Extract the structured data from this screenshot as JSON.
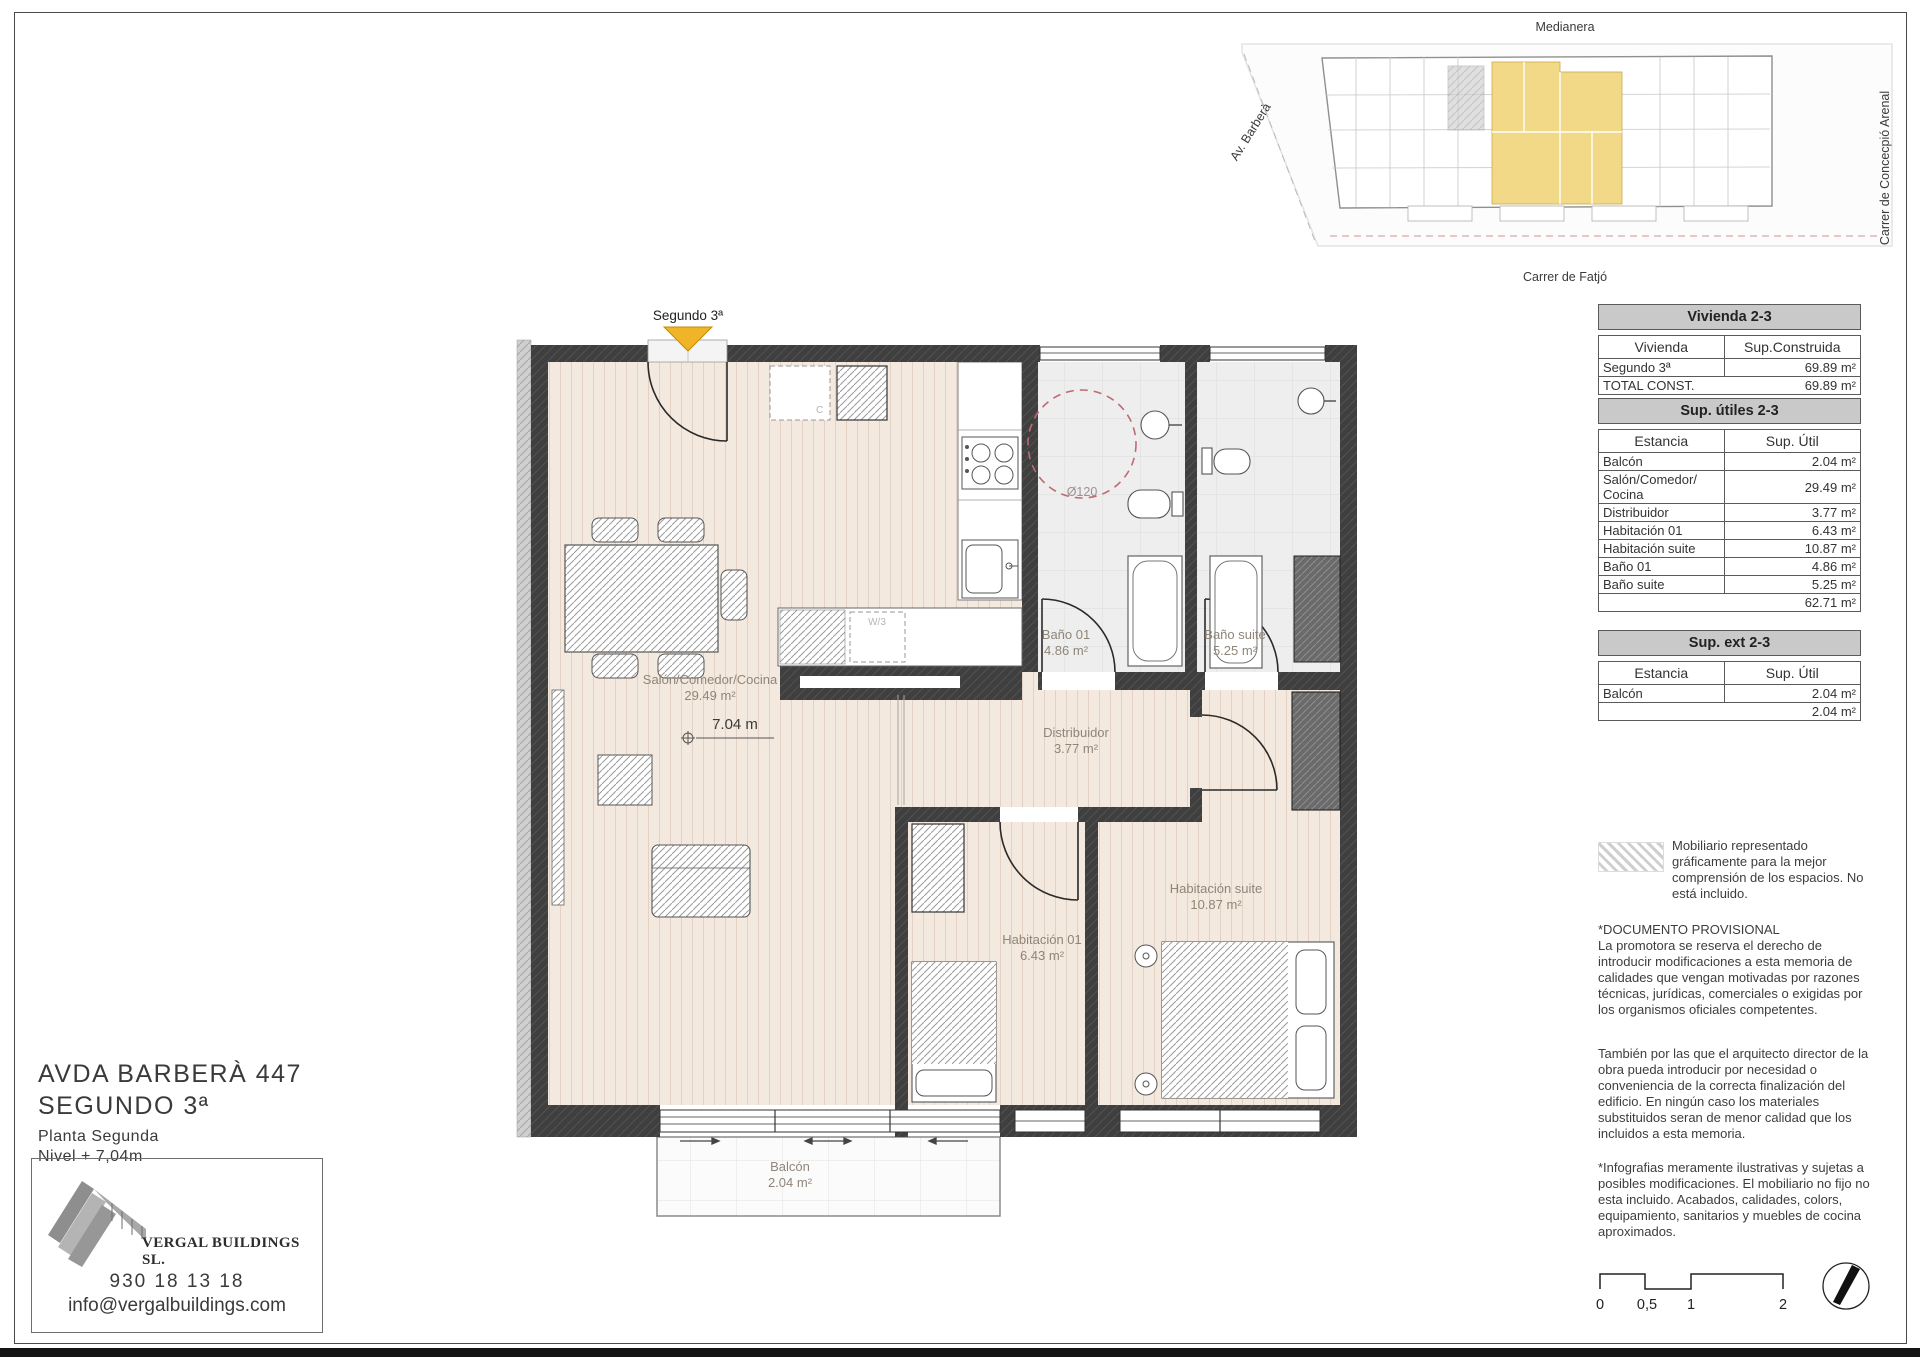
{
  "site": {
    "top": "Medianera",
    "left": "Av. Barberà",
    "right": "Carrer de Concecpió Arenal",
    "bottom": "Carrer de Fatjó"
  },
  "plan": {
    "entrance": "Segundo 3ª",
    "dim": "7.04 m",
    "turning_circle": "Ø120",
    "cabinet": "C",
    "washer": "W/3",
    "rooms": {
      "salon": {
        "name": "Salón/Comedor/Cocina",
        "area": "29.49 m²"
      },
      "bano01": {
        "name": "Baño 01",
        "area": "4.86 m²"
      },
      "banosuite": {
        "name": "Baño suite",
        "area": "5.25 m²"
      },
      "distribuidor": {
        "name": "Distribuidor",
        "area": "3.77 m²"
      },
      "hab01": {
        "name": "Habitación 01",
        "area": "6.43 m²"
      },
      "habsuite": {
        "name": "Habitación suite",
        "area": "10.87 m²"
      },
      "balcon": {
        "name": "Balcón",
        "area": "2.04 m²"
      }
    }
  },
  "tables": {
    "vivienda": {
      "title": "Vivienda 2-3",
      "col1": "Vivienda",
      "col2": "Sup.Construida",
      "rows": [
        [
          "Segundo 3ª",
          "69.89 m²"
        ],
        [
          "TOTAL CONST.",
          "69.89 m²"
        ]
      ]
    },
    "utiles": {
      "title": "Sup. útiles 2-3",
      "col1": "Estancia",
      "col2": "Sup. Útil",
      "rows": [
        [
          "Balcón",
          "2.04 m²"
        ],
        [
          "Salón/Comedor/ Cocina",
          "29.49 m²"
        ],
        [
          "Distribuidor",
          "3.77 m²"
        ],
        [
          "Habitación 01",
          "6.43 m²"
        ],
        [
          "Habitación suite",
          "10.87 m²"
        ],
        [
          "Baño 01",
          "4.86 m²"
        ],
        [
          "Baño suite",
          "5.25 m²"
        ]
      ],
      "total": "62.71 m²"
    },
    "ext": {
      "title": "Sup. ext 2-3",
      "col1": "Estancia",
      "col2": "Sup. Útil",
      "rows": [
        [
          "Balcón",
          "2.04 m²"
        ]
      ],
      "total": "2.04 m²"
    }
  },
  "notes": {
    "mobiliario": "Mobiliario representado gráficamente para la mejor comprensión de los espacios. No está incluido.",
    "provisional_title": "*DOCUMENTO PROVISIONAL",
    "provisional_body": "La promotora se reserva el derecho de introducir modificaciones a esta memoria de calidades que vengan motivadas por razones técnicas, jurídicas, comerciales o exigidas por los organismos oficiales competentes.",
    "arquitecto": "También por las que el arquitecto director de la obra pueda introducir por necesidad o conveniencia de la correcta finalización del edificio. En ningún caso los materiales substituidos seran de menor calidad que los incluidos a esta memoria.",
    "infografias": "*Infografias meramente ilustrativas y sujetas a posibles modificaciones. El mobiliario no fijo no esta incluido. Acabados, calidades, colors, equipamiento, sanitarios y muebles de cocina aproximados."
  },
  "project": {
    "address": "AVDA BARBERÀ 447",
    "unit": "SEGUNDO 3ª",
    "floor": "Planta Segunda",
    "level": "Nivel + 7,04m",
    "company": "VERGAL BUILDINGS SL.",
    "phone": "930 18 13 18",
    "email": "info@vergalbuildings.com"
  },
  "scalebar": {
    "t0": "0",
    "t1": "0,5",
    "t2": "1",
    "t3": "2"
  },
  "colors": {
    "highlight_yellow": "#f2d987",
    "marker_yellow": "#f0b429",
    "turning_circle_red": "#bf6a72",
    "wall_dark": "#3f3f3f",
    "wood_floor": "#f3e9df"
  }
}
